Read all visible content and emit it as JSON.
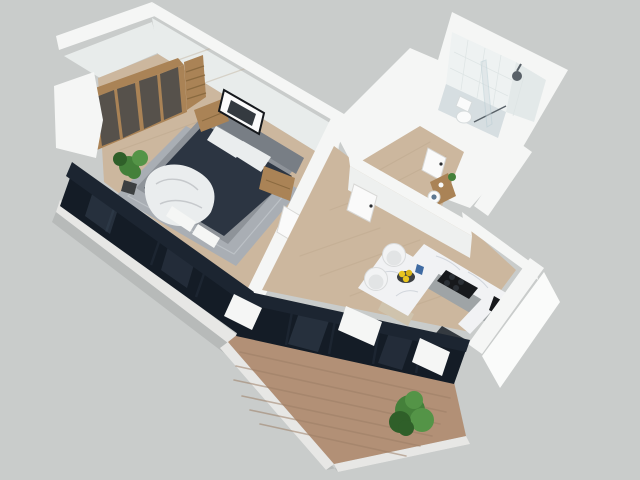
{
  "scene": {
    "type": "isometric-3d-floorplan-render",
    "description": "3D cutaway render of a one-bedroom apartment viewed from above on a flat grey backdrop",
    "background": "#c9cccb"
  },
  "palette": {
    "bg": "#c9cccb",
    "wall_white": "#f5f6f5",
    "wall_bright": "#fafbfa",
    "wall_face": "#e8eceb",
    "wall_face_soft": "#eef0ef",
    "slab": "#e7e7e5",
    "slab_shadow": "#b7bab9",
    "wood_floor": "#ccb79e",
    "wood_plank": "#b7a287",
    "wood_deck": "#b29076",
    "deck_plank": "#9d7f66",
    "frame_dark": "#1c2531",
    "glazing": "#141c26",
    "glass_tint": "#7b90a8",
    "rug": "#a9aeb4",
    "rug_line": "#bcc1c6",
    "bed_frame": "#8e9399",
    "headboard": "#787e85",
    "duvet": "#2c3542",
    "linen": "#eaedee",
    "wood_furniture": "#aa8356",
    "wood_dark": "#8a6a40",
    "wardrobe_glass": "#56514b",
    "marble": "#f1f2f4",
    "marble_vein": "#c9ced6",
    "cabinet": "#9fa4a6",
    "table_base": "#cfc3ad",
    "appliance_black": "#17191c",
    "burner": "#2b3036",
    "counter_dark": "#343a40",
    "pane_blue": "#5d7892",
    "tile_wall": "#eef2f2",
    "tile_wall_side": "#e3e9e9",
    "tile_floor": "#d6dee1",
    "tile_line": "#dde4e4",
    "fixture_white": "#fafbfb",
    "fixture_line": "#d6dbdc",
    "door_white": "#fafafa",
    "door_edge": "#d8d8d6",
    "handle": "#2a2d31",
    "chair_white": "#f2f3f4",
    "chair_shade": "#e2e4e5",
    "chair_edge": "#d9dbdc",
    "plant": "#44803a",
    "plant_dark": "#2f5f29",
    "plant_light": "#549447",
    "pot": "#3c3f41",
    "fruit": "#e9c61f",
    "fruit_dark": "#d9b517",
    "glass_blue": "#3f6ba3",
    "metal": "#596168"
  },
  "rooms": [
    {
      "id": "bedroom",
      "label": "Bedroom",
      "floor": "light oak",
      "contents": [
        "sliding-door wardrobe with smoked glass",
        "open wooden shelving unit",
        "double bed with navy duvet and white pillows",
        "white throw blanket",
        "two wooden nightstands",
        "framed wall art",
        "grey area rug",
        "potted plant",
        "dark-framed window wall"
      ]
    },
    {
      "id": "hallway",
      "label": "Hallway",
      "floor": "light oak",
      "contents": [
        "three white interior doors",
        "wooden console",
        "small white appliance"
      ]
    },
    {
      "id": "bathroom",
      "label": "Bathroom",
      "floor": "light grey tile",
      "contents": [
        "toilet",
        "walk-in shower with glass partition",
        "rain shower head",
        "white tiled walls"
      ]
    },
    {
      "id": "kitchen_living",
      "label": "Kitchen / Dining",
      "floor": "light oak",
      "contents": [
        "L-shaped white marble counter",
        "black induction cooktop",
        "grey base cabinets",
        "coffee machine",
        "dark counter with blue panel",
        "marble dining table",
        "two white shell chairs",
        "bowl of yellow fruit",
        "blue glass"
      ]
    },
    {
      "id": "balcony",
      "label": "Balcony",
      "floor": "wood decking",
      "contents": [
        "dark-framed sliding glass wall",
        "white pillars",
        "green shrub",
        "white parapet"
      ]
    }
  ]
}
